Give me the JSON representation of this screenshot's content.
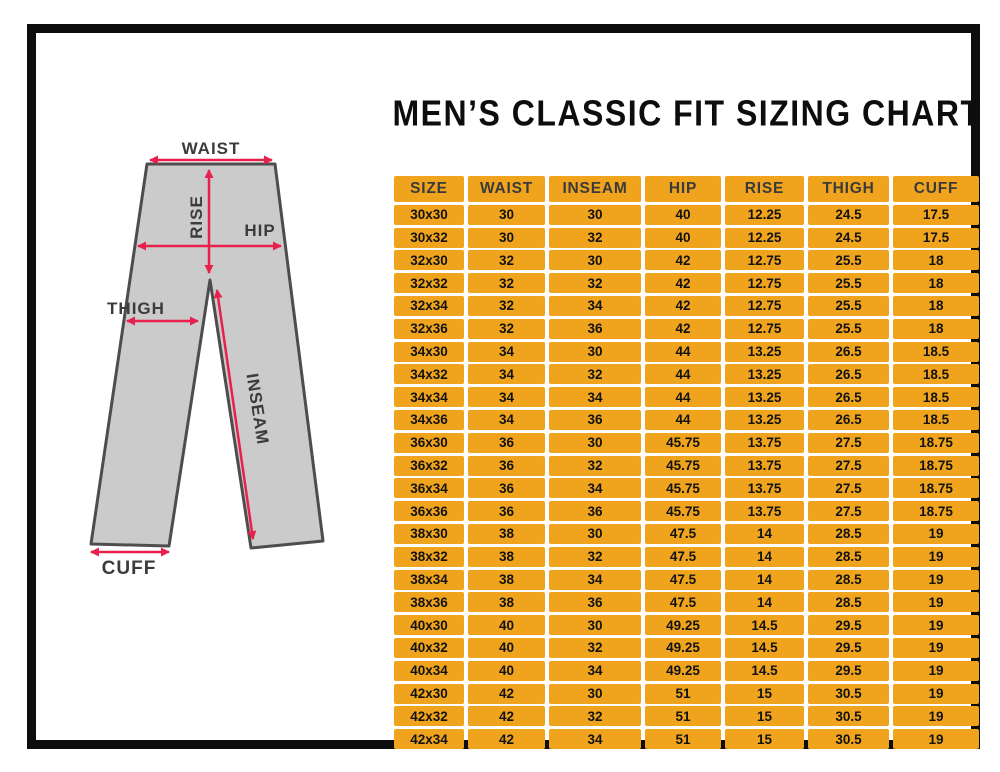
{
  "title": "MEN’S CLASSIC FIT SIZING CHART",
  "diagram": {
    "labels": {
      "waist": "WAIST",
      "rise": "RISE",
      "hip": "HIP",
      "thigh": "THIGH",
      "inseam": "INSEAM",
      "cuff": "CUFF"
    },
    "colors": {
      "pants_fill": "#cbcbcb",
      "pants_outline": "#4d4d4d",
      "arrow": "#e8204b",
      "label_text": "#3b3b3b"
    }
  },
  "table_style": {
    "cell_background": "#f0a41e",
    "header_text_color": "#3a3a3a",
    "cell_text_color": "#121212"
  },
  "chart_data": {
    "type": "table",
    "title": "MEN’S CLASSIC FIT SIZING CHART",
    "columns": [
      "SIZE",
      "WAIST",
      "INSEAM",
      "HIP",
      "RISE",
      "THIGH",
      "CUFF"
    ],
    "rows": [
      [
        "30x30",
        "30",
        "30",
        "40",
        "12.25",
        "24.5",
        "17.5"
      ],
      [
        "30x32",
        "30",
        "32",
        "40",
        "12.25",
        "24.5",
        "17.5"
      ],
      [
        "32x30",
        "32",
        "30",
        "42",
        "12.75",
        "25.5",
        "18"
      ],
      [
        "32x32",
        "32",
        "32",
        "42",
        "12.75",
        "25.5",
        "18"
      ],
      [
        "32x34",
        "32",
        "34",
        "42",
        "12.75",
        "25.5",
        "18"
      ],
      [
        "32x36",
        "32",
        "36",
        "42",
        "12.75",
        "25.5",
        "18"
      ],
      [
        "34x30",
        "34",
        "30",
        "44",
        "13.25",
        "26.5",
        "18.5"
      ],
      [
        "34x32",
        "34",
        "32",
        "44",
        "13.25",
        "26.5",
        "18.5"
      ],
      [
        "34x34",
        "34",
        "34",
        "44",
        "13.25",
        "26.5",
        "18.5"
      ],
      [
        "34x36",
        "34",
        "36",
        "44",
        "13.25",
        "26.5",
        "18.5"
      ],
      [
        "36x30",
        "36",
        "30",
        "45.75",
        "13.75",
        "27.5",
        "18.75"
      ],
      [
        "36x32",
        "36",
        "32",
        "45.75",
        "13.75",
        "27.5",
        "18.75"
      ],
      [
        "36x34",
        "36",
        "34",
        "45.75",
        "13.75",
        "27.5",
        "18.75"
      ],
      [
        "36x36",
        "36",
        "36",
        "45.75",
        "13.75",
        "27.5",
        "18.75"
      ],
      [
        "38x30",
        "38",
        "30",
        "47.5",
        "14",
        "28.5",
        "19"
      ],
      [
        "38x32",
        "38",
        "32",
        "47.5",
        "14",
        "28.5",
        "19"
      ],
      [
        "38x34",
        "38",
        "34",
        "47.5",
        "14",
        "28.5",
        "19"
      ],
      [
        "38x36",
        "38",
        "36",
        "47.5",
        "14",
        "28.5",
        "19"
      ],
      [
        "40x30",
        "40",
        "30",
        "49.25",
        "14.5",
        "29.5",
        "19"
      ],
      [
        "40x32",
        "40",
        "32",
        "49.25",
        "14.5",
        "29.5",
        "19"
      ],
      [
        "40x34",
        "40",
        "34",
        "49.25",
        "14.5",
        "29.5",
        "19"
      ],
      [
        "42x30",
        "42",
        "30",
        "51",
        "15",
        "30.5",
        "19"
      ],
      [
        "42x32",
        "42",
        "32",
        "51",
        "15",
        "30.5",
        "19"
      ],
      [
        "42x34",
        "42",
        "34",
        "51",
        "15",
        "30.5",
        "19"
      ]
    ]
  }
}
